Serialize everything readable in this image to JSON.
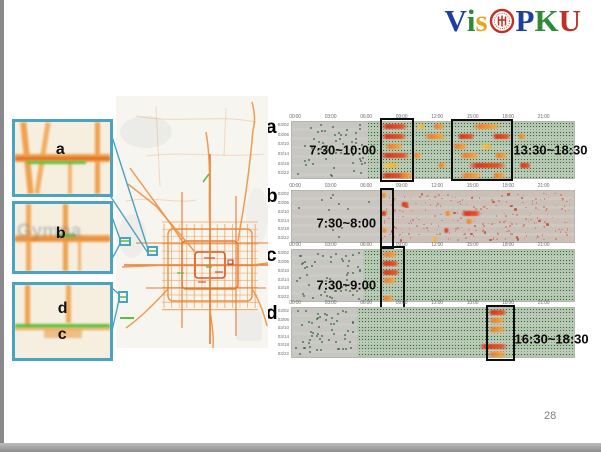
{
  "slide": {
    "page_number": "28"
  },
  "logo": {
    "text": "VisPKU",
    "seal_color": "#c03025",
    "letters": [
      {
        "ch": "V",
        "color": "#1e3f9e"
      },
      {
        "ch": "i",
        "color": "#2f8a35"
      },
      {
        "ch": "s",
        "color": "#e6a71c"
      },
      {
        "ch": "seal",
        "color": "#c03025"
      },
      {
        "ch": "P",
        "color": "#1e3f9e"
      },
      {
        "ch": "K",
        "color": "#2f8a35"
      },
      {
        "ch": "U",
        "color": "#c03025"
      }
    ]
  },
  "map": {
    "type": "city-traffic-map",
    "watermark": "Gymna",
    "inset_border_color": "#4aa3c0",
    "road_colors": {
      "congested": "#d8401f",
      "busy": "#ee8f3f",
      "free": "#5fc13b"
    },
    "insets": [
      {
        "id": "a",
        "labels": [
          "a"
        ]
      },
      {
        "id": "b",
        "labels": [
          "b"
        ]
      },
      {
        "id": "dc",
        "labels": [
          "d",
          "c"
        ]
      }
    ]
  },
  "chart_data": [
    {
      "id": "a",
      "type": "heatmap",
      "x_ticks": [
        "00:00",
        "03:00",
        "06:00",
        "09:00",
        "12:00",
        "15:00",
        "18:00",
        "21:00"
      ],
      "x_range_hours": [
        0,
        24
      ],
      "y_ticks": [
        "03/02",
        "03/06",
        "03/10",
        "03/14",
        "03/18",
        "03/22"
      ],
      "texture": "green-dots",
      "inactive_gray_until_hour": 6.5,
      "highlights": [
        {
          "label": "7:30~10:00",
          "from_hour": 7.5,
          "to_hour": 10.0,
          "label_side": "left"
        },
        {
          "label": "13:30~18:30",
          "from_hour": 13.5,
          "to_hour": 18.5,
          "label_side": "right"
        }
      ],
      "hotspots": [
        [
          0,
          7.6,
          9.9,
          "high"
        ],
        [
          0,
          12.0,
          13.0,
          "med"
        ],
        [
          0,
          15.3,
          17.8,
          "med"
        ],
        [
          0,
          10.6,
          11.3,
          "low"
        ],
        [
          1,
          7.6,
          9.8,
          "high"
        ],
        [
          1,
          11.2,
          13.2,
          "med"
        ],
        [
          1,
          14.0,
          15.6,
          "high"
        ],
        [
          1,
          17.0,
          18.6,
          "high"
        ],
        [
          1,
          19.2,
          19.9,
          "med"
        ],
        [
          2,
          7.8,
          9.5,
          "med"
        ],
        [
          2,
          13.6,
          15.0,
          "med"
        ],
        [
          2,
          16.0,
          17.1,
          "low"
        ],
        [
          3,
          7.5,
          10.0,
          "high"
        ],
        [
          3,
          10.3,
          11.1,
          "med"
        ],
        [
          3,
          14.2,
          16.0,
          "med"
        ],
        [
          3,
          17.2,
          18.4,
          "med"
        ],
        [
          4,
          7.6,
          9.2,
          "low"
        ],
        [
          4,
          12.4,
          13.1,
          "med"
        ],
        [
          4,
          15.0,
          18.3,
          "high"
        ],
        [
          4,
          19.3,
          20.3,
          "high"
        ],
        [
          5,
          7.5,
          9.9,
          "high"
        ],
        [
          5,
          9.1,
          10.4,
          "med"
        ],
        [
          5,
          14.3,
          16.2,
          "med"
        ],
        [
          5,
          17.0,
          18.2,
          "med"
        ]
      ]
    },
    {
      "id": "b",
      "type": "heatmap",
      "x_ticks": [
        "00:00",
        "03:00",
        "06:00",
        "09:00",
        "12:00",
        "15:00",
        "18:00",
        "21:00"
      ],
      "x_range_hours": [
        0,
        24
      ],
      "y_ticks": [
        "03/02",
        "03/06",
        "03/10",
        "03/14",
        "03/18",
        "03/22"
      ],
      "texture": "sparse-red",
      "inactive_gray_until_hour": 24,
      "active_from_hour": 7.5,
      "highlights": [
        {
          "label": "7:30~8:00",
          "from_hour": 7.5,
          "to_hour": 8.3,
          "label_side": "left"
        }
      ],
      "hotspots": [
        [
          0,
          7.6,
          8.1,
          "med"
        ],
        [
          1,
          9.3,
          10.0,
          "high"
        ],
        [
          2,
          7.6,
          8.1,
          "high"
        ],
        [
          2,
          13.0,
          13.5,
          "med"
        ],
        [
          2,
          14.4,
          16.1,
          "high"
        ],
        [
          3,
          14.8,
          15.4,
          "med"
        ],
        [
          4,
          7.7,
          8.1,
          "med"
        ],
        [
          4,
          12.9,
          13.4,
          "high"
        ],
        [
          5,
          11.8,
          12.3,
          "low"
        ]
      ]
    },
    {
      "id": "c",
      "type": "heatmap",
      "x_ticks": [
        "00:00",
        "03:00",
        "06:00",
        "09:00",
        "12:00",
        "15:00",
        "18:00",
        "21:00"
      ],
      "x_range_hours": [
        0,
        24
      ],
      "y_ticks": [
        "03/02",
        "03/06",
        "03/10",
        "03/14",
        "03/18",
        "03/22"
      ],
      "texture": "green-dots",
      "inactive_gray_until_hour": 6.0,
      "highlights": [
        {
          "label": "7:30~9:00",
          "from_hour": 7.5,
          "to_hour": 9.3,
          "label_side": "left"
        }
      ],
      "hotspots": [
        [
          0,
          7.7,
          9.0,
          "med"
        ],
        [
          1,
          7.6,
          9.1,
          "high"
        ],
        [
          2,
          7.6,
          9.2,
          "high"
        ],
        [
          3,
          7.7,
          8.9,
          "med"
        ],
        [
          5,
          7.7,
          8.7,
          "med"
        ]
      ]
    },
    {
      "id": "d",
      "type": "heatmap",
      "x_ticks": [
        "00:00",
        "03:00",
        "06:00",
        "09:00",
        "12:00",
        "15:00",
        "18:00",
        "21:00"
      ],
      "x_range_hours": [
        0,
        24
      ],
      "y_ticks": [
        "03/02",
        "03/06",
        "03/10",
        "03/14",
        "03/18",
        "03/22"
      ],
      "texture": "green-dots",
      "inactive_gray_until_hour": 5.5,
      "highlights": [
        {
          "label": "16:30~18:30",
          "from_hour": 16.5,
          "to_hour": 18.6,
          "label_side": "right"
        }
      ],
      "hotspots": [
        [
          0,
          16.7,
          18.3,
          "high"
        ],
        [
          1,
          16.8,
          18.1,
          "med"
        ],
        [
          2,
          16.7,
          18.2,
          "med"
        ],
        [
          4,
          15.9,
          18.4,
          "high"
        ],
        [
          5,
          16.6,
          18.3,
          "med"
        ]
      ]
    }
  ]
}
